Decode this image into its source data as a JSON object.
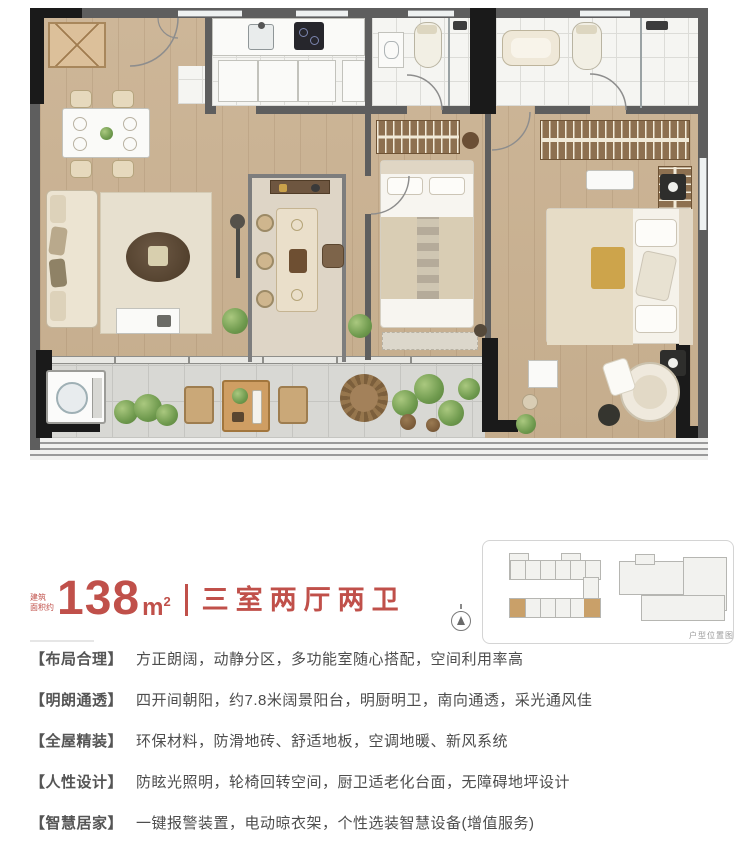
{
  "title": {
    "area_prefix_line1": "建筑",
    "area_prefix_line2": "面积约",
    "area_value": "138",
    "area_unit": "m",
    "area_sup": "2",
    "layout": "三室两厅两卫"
  },
  "locator": {
    "caption": "户型位置图"
  },
  "features": [
    {
      "tag": "【布局合理】",
      "desc": "方正朗阔，动静分区，多功能室随心搭配，空间利用率高"
    },
    {
      "tag": "【明朗通透】",
      "desc": "四开间朝阳，约7.8米阔景阳台，明厨明卫，南向通透，采光通风佳"
    },
    {
      "tag": "【全屋精装】",
      "desc": "环保材料，防滑地砖、舒适地板，空调地暖、新风系统"
    },
    {
      "tag": "【人性设计】",
      "desc": "防眩光照明，轮椅回转空间，厨卫适老化台面，无障碍地坪设计"
    },
    {
      "tag": "【智慧居家】",
      "desc": "一键报警装置，电动晾衣架，个性选装智慧设备(增值服务)"
    }
  ],
  "colors": {
    "accent_red": "#c0504a",
    "text_gray": "#4d4d4d",
    "wall_gray": "#5e5e5e",
    "wood_floor": "#cdb698",
    "unit_highlight": "#c9a069"
  }
}
